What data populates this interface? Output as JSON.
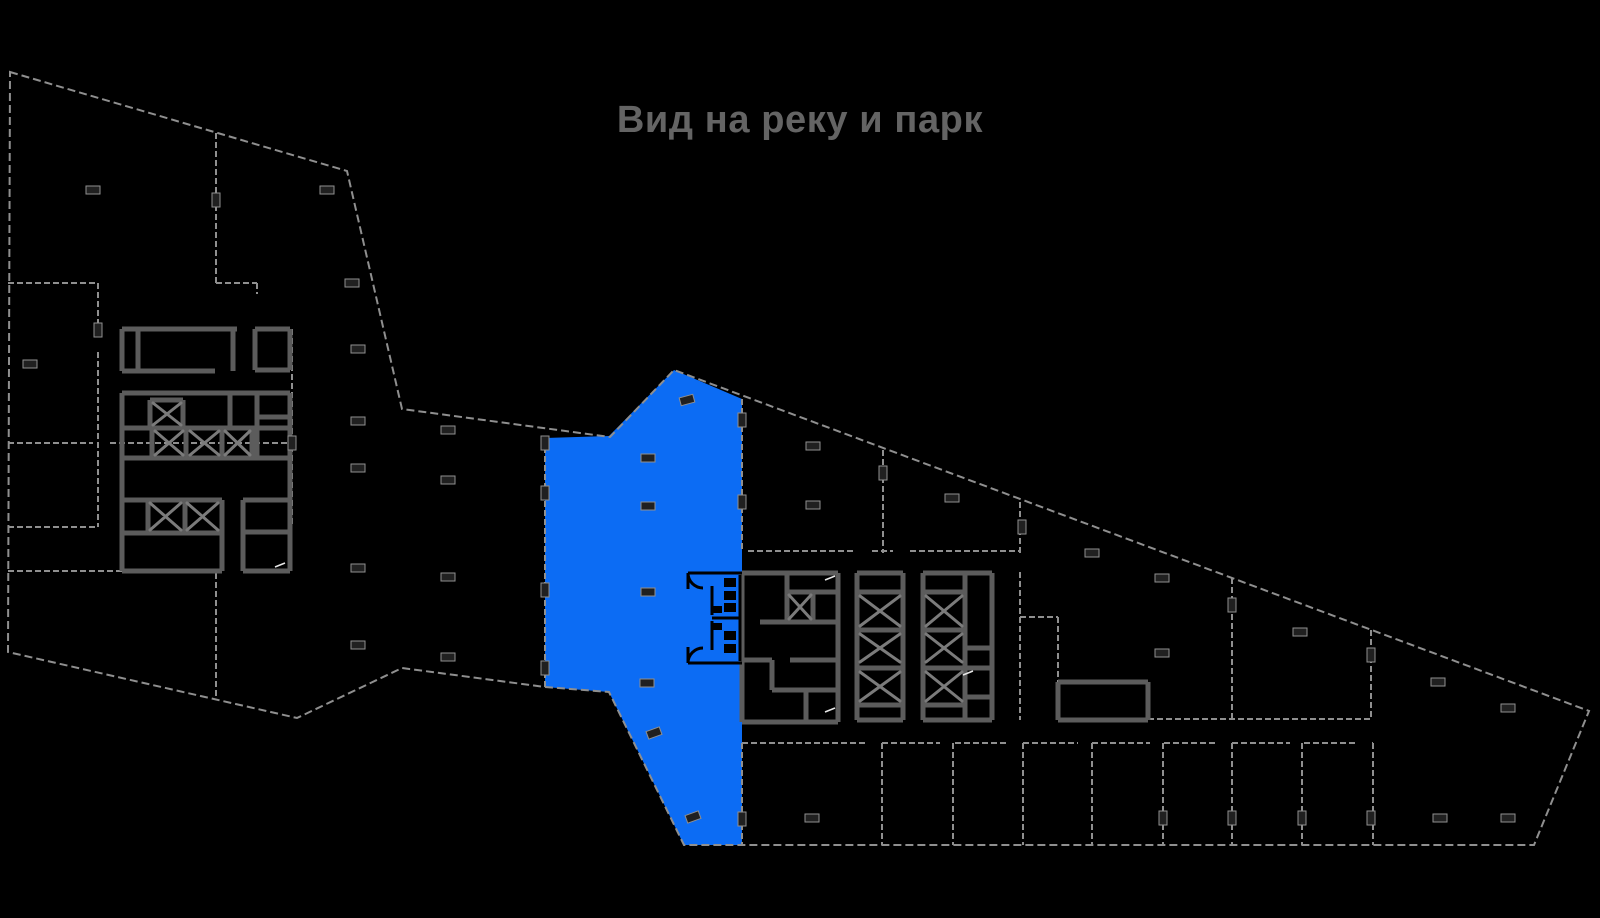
{
  "header": {
    "view_label": "Вид на реку и парк",
    "text_color": "#646464"
  },
  "plan": {
    "background_color": "#000000",
    "highlight_color": "#0c6cf4",
    "wall_color_light": "#8f8f8f",
    "wall_color_heavy": "#5c5c5c",
    "shaft_mark_color": "#7b7b7b",
    "column_fill_color": "#202020",
    "sanitary_detail_color": "#000000",
    "door_arrow_color": "#e8e8e8"
  }
}
